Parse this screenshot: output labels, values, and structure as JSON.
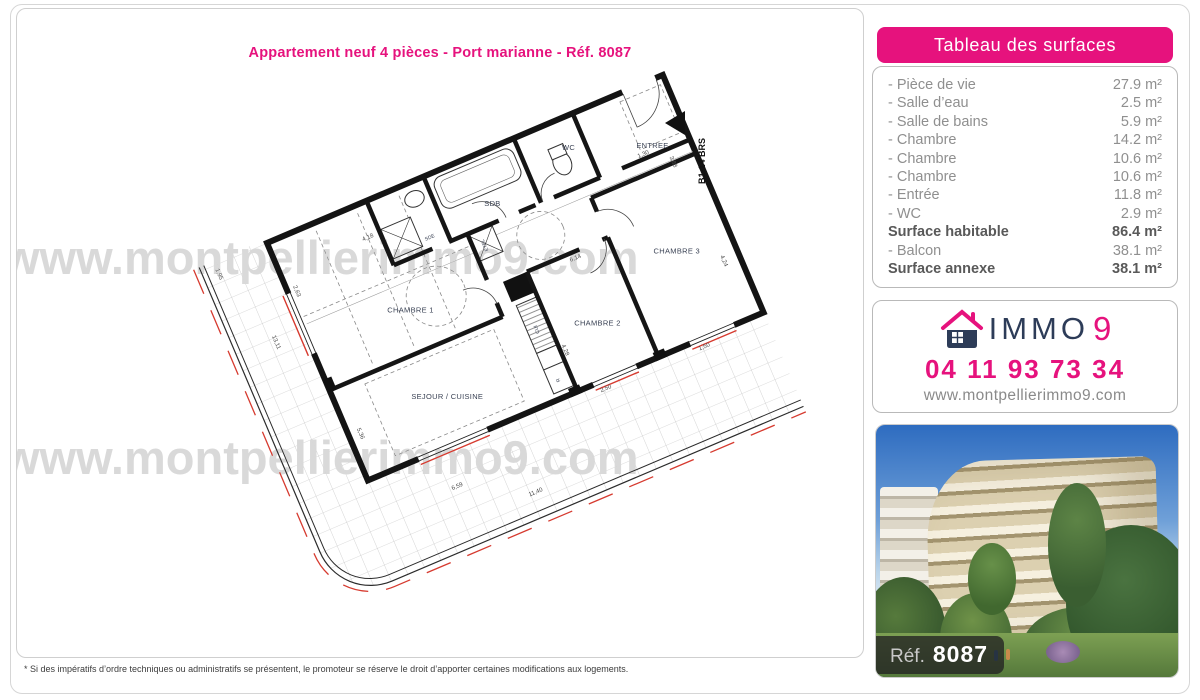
{
  "title": "Appartement neuf 4 pièces - Port marianne - Réf. 8087",
  "watermark": "www.montpellierimmo9.com",
  "disclaimer": "* Si des impératifs d’ordre techniques ou administratifs se présentent, le promoteur se réserve le droit d’apporter certaines modifications aux logements.",
  "colors": {
    "accent": "#e6127d",
    "navy": "#2d3c58"
  },
  "surfaces": {
    "header": "Tableau des surfaces",
    "rows": [
      {
        "label": "- Pièce de vie",
        "value": "27.9 m²",
        "bold": false
      },
      {
        "label": "- Salle d’eau",
        "value": "2.5 m²",
        "bold": false
      },
      {
        "label": "- Salle de bains",
        "value": "5.9 m²",
        "bold": false
      },
      {
        "label": "- Chambre",
        "value": "14.2 m²",
        "bold": false
      },
      {
        "label": "- Chambre",
        "value": "10.6 m²",
        "bold": false
      },
      {
        "label": "- Chambre",
        "value": "10.6 m²",
        "bold": false
      },
      {
        "label": "- Entrée",
        "value": "11.8 m²",
        "bold": false
      },
      {
        "label": "- WC",
        "value": "2.9 m²",
        "bold": false
      },
      {
        "label": "Surface habitable",
        "value": "86.4 m²",
        "bold": true
      },
      {
        "label": "- Balcon",
        "value": "38.1 m²",
        "bold": false
      },
      {
        "label": "Surface annexe",
        "value": "38.1 m²",
        "bold": true
      }
    ]
  },
  "agency": {
    "brand_immo": "IMMO",
    "brand_9": "9",
    "phone": "04 11 93 73 34",
    "website": "www.montpellierimmo9.com"
  },
  "photo": {
    "ref_label": "Réf.",
    "ref_number": "8087"
  },
  "plan": {
    "unit": "B1-14 BRS",
    "rooms": {
      "chambre1": "CHAMBRE 1",
      "chambre2": "CHAMBRE 2",
      "chambre3": "CHAMBRE 3",
      "sejour": "SEJOUR / CUISINE",
      "sdb": "SDB",
      "wc": "WC",
      "entree": "ENTREE",
      "sde": "SDE",
      "etel": "ETEL",
      "cui": "CUI",
      "r": "R"
    },
    "dims": [
      "4,18",
      "1,95",
      "13,11",
      "2,63",
      "5,36",
      "6,59",
      "11,40",
      "2,50",
      "1,50",
      "4,24",
      "6,14",
      "4,28",
      "1,30",
      "3,88"
    ]
  }
}
